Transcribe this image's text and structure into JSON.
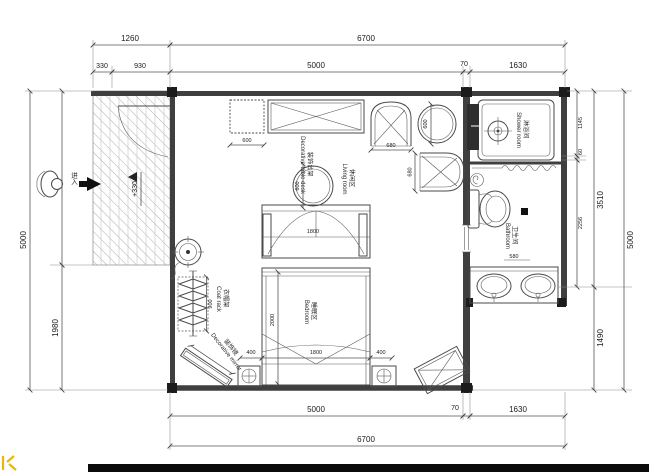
{
  "colors": {
    "line": "#3f3f3f",
    "accent_yellow": "#e8b70a",
    "footer_bar": "#0b0b0b"
  },
  "labels": {
    "shower_cn": "淋浴间",
    "shower_en": "Shower room",
    "bath_cn": "卫生间",
    "bath_en": "Bathroom",
    "living_cn": "休闲区",
    "living_en": "Living room",
    "bedroom_cn": "睡眠区",
    "bedroom_en": "Bedroom",
    "coat_cn": "衣帽架",
    "coat_en": "Coat rack",
    "mirror_cn": "装饰镜",
    "mirror_en": "Decorative mirror",
    "dectable_cn": "装饰台架",
    "dectable_en": "Decorative table desk",
    "entry": "进入",
    "level": "+330"
  },
  "dims": {
    "top_porch": "1260",
    "top_porch_a": "330",
    "top_porch_b": "930",
    "top_total": "6700",
    "top_main": "5000",
    "top_wall": "70",
    "top_right": "1630",
    "bottom_main": "5000",
    "bottom_wall": "70",
    "bottom_right": "1630",
    "bottom_total": "6700",
    "left_total": "5000",
    "left_lower": "1980",
    "right_shower": "1145",
    "right_wall": "60",
    "right_bath": "2256",
    "right_upper": "3510",
    "right_lower": "1490",
    "right_total": "5000",
    "cabinet": "600",
    "round_table": "600",
    "side_table": "600",
    "chair_w": "680",
    "chair_gap": "680",
    "wardrobe": "1800",
    "bed_w": "1800",
    "bed_l": "2000",
    "bed_side_l": "400",
    "bed_side_r": "400",
    "coat_rack": "900",
    "vanity": "580"
  }
}
